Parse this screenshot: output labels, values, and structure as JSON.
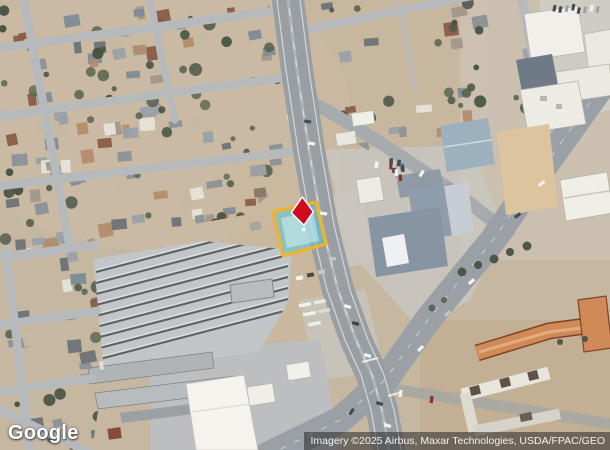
{
  "map_view": {
    "logo_text": "Google",
    "attribution_text": "Imagery ©2025 Airbus, Maxar Technologies, USDA/FPAC/GEO",
    "parcel_overlay": {
      "fill_color": "#5bc8da",
      "building_tint_color": "#cfeef2",
      "border_color": "#f2b422",
      "pin_color": "#d00b1d",
      "pin_outline_color": "#ffffff"
    }
  }
}
